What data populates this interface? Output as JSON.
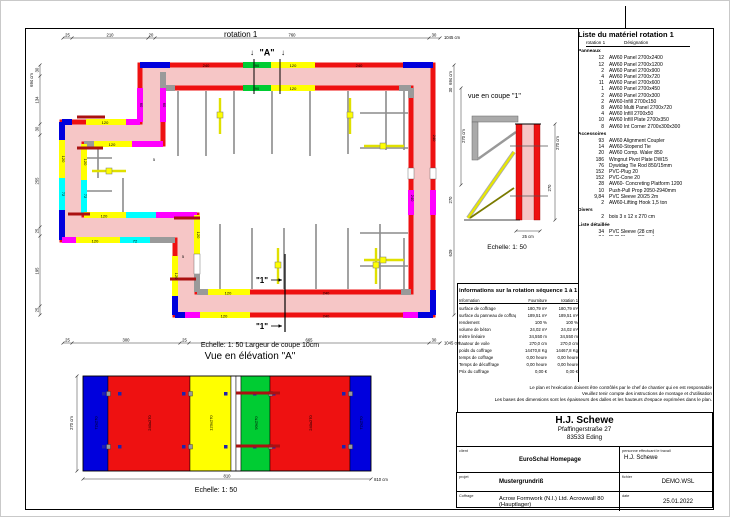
{
  "page": {
    "plan_heading": "rotation 1",
    "scale_note": "Echelle: 1: 50   Largeur de coupe 10cm",
    "elevation_title": "Vue en élévation \"A\"",
    "elevation_scale": "Echelle: 1: 50",
    "section_title": "vue en coupe \"1\"",
    "section_scale": "Echelle: 1: 50",
    "marker_a": "\"A\"",
    "marker_1": "\"1\"",
    "arrow_down": "↓"
  },
  "plan": {
    "labels": {
      "p240": "240",
      "p120": "120",
      "p90": "90",
      "p60": "60",
      "p72": "72",
      "p5": "5"
    },
    "dims_top": {
      "d1": "25",
      "d2": "210",
      "d3": "20",
      "d4": "760",
      "d5": "30",
      "total": "1045 cm"
    },
    "dims_bottom": {
      "d1": "25",
      "d2": "300",
      "d3": "25",
      "d4": "665",
      "d5": "30",
      "total": "1045 cm"
    },
    "dims_left": {
      "total": "694 cm",
      "d1": "30",
      "d2": "134",
      "d3": "30",
      "d4": "255",
      "d5": "25",
      "d6": "195",
      "d7": "25"
    },
    "dims_right": {
      "total": "694 cm",
      "d1": "30",
      "d2": "270 cm",
      "d3": "270",
      "d4": "629"
    }
  },
  "section": {
    "dim_height": "270 cm",
    "dim_wall": "270",
    "dim_width": "25 cm"
  },
  "elevation": {
    "dim_total_short": "810",
    "dim_total": "810 cm",
    "dim_height": "270 cm",
    "panels": [
      {
        "label": "72x270",
        "color": "#0000dd",
        "x": 25,
        "w": 25
      },
      {
        "label": "240x270",
        "color": "#ee1111",
        "x": 50,
        "w": 82
      },
      {
        "label": "120x270",
        "color": "#ffff00",
        "x": 132,
        "w": 41
      },
      {
        "label": "",
        "color": "#ffffff",
        "x": 173,
        "w": 5
      },
      {
        "label": "",
        "color": "#ffffff",
        "x": 178,
        "w": 5
      },
      {
        "label": "90x270",
        "color": "#00cc33",
        "x": 183,
        "w": 29
      },
      {
        "label": "240x270",
        "color": "#ee1111",
        "x": 212,
        "w": 80
      },
      {
        "label": "72x270",
        "color": "#0000dd",
        "x": 292,
        "w": 21
      }
    ]
  },
  "material_list": {
    "title": "Liste du matériel  rotation 1",
    "col_qty": "rotation 1",
    "col_name": "Désignation",
    "sections": [
      {
        "name": "Panneaux",
        "items": [
          [
            "12",
            "AW60 Panel 2700x2400"
          ],
          [
            "12",
            "AW60 Panel 2700x1200"
          ],
          [
            "2",
            "AW60 Panel 2700x900"
          ],
          [
            "4",
            "AW60 Panel 2700x720"
          ],
          [
            "11",
            "AW60 Panel 2700x600"
          ],
          [
            "1",
            "AW60 Panel 2700x450"
          ],
          [
            "2",
            "AW60 Panel 2700x300"
          ],
          [
            "2",
            "AW60-Infill 2700x150"
          ],
          [
            "8",
            "AW60 Multi Panel 2700x720"
          ],
          [
            "4",
            "AW60 Infill 2700x50"
          ],
          [
            "10",
            "AW60 Infill Plate 2700x350"
          ],
          [
            "8",
            "AW60 Int Corner 2700x300x300"
          ]
        ]
      },
      {
        "name": "Accessoires",
        "items": [
          [
            "93",
            "AW60 Alignment Coupler"
          ],
          [
            "14",
            "AW60-Stopend Tie"
          ],
          [
            "20",
            "AW60 Comp. Waler 850"
          ],
          [
            "186",
            "Wingnut Pivot Plate DW15"
          ],
          [
            "76",
            "Dywidag Tie Rod  850/15mm"
          ],
          [
            "152",
            "PVC-Plug 20"
          ],
          [
            "152",
            "PVC-Cone 20"
          ],
          [
            "28",
            "AW60- Concreting Platform 1200"
          ],
          [
            "10",
            "Push-Pull Prop 2050-2940mm"
          ],
          [
            "9,84",
            "PVC Sleeve 20/25  2m"
          ],
          [
            "2",
            "AW60-Lifting Hook 1,5 ton"
          ]
        ]
      },
      {
        "name": "Divers",
        "items": [
          [
            "2",
            "bois 3 x 12 x 270 cm"
          ]
        ]
      },
      {
        "name": "Liste détaillée",
        "items": [
          [
            "34",
            "PVC Sleeve  (28 cm)"
          ],
          [
            "34",
            "PVC Sleeve  (23 cm)"
          ],
          [
            "8",
            "PVC Sleeve  (18 cm)"
          ]
        ]
      }
    ]
  },
  "info_table": {
    "title": "informations sur la rotation  séquence 1 à 1",
    "col_info": "Information",
    "col_supply": "Fourniture",
    "col_rot": "rotation 1",
    "rows": [
      [
        "surface de coffrage",
        "180,79 m²",
        "180,79 m²"
      ],
      [
        "surface du panneau de coffrage",
        "189,51 m²",
        "189,51 m²"
      ],
      [
        "rendement",
        "100 %",
        "100 %"
      ],
      [
        "volume de béton",
        "24,02 m³",
        "24,02 m³"
      ],
      [
        "mètre linéaire",
        "34,550 m",
        "34,550 m"
      ],
      [
        "hauteur de voile",
        "270,0 cm",
        "270,0 cm"
      ],
      [
        "poids du coffrage",
        "14470,8 Kg",
        "14467,8 Kg"
      ],
      [
        "temps de coffrage",
        "0,00 heure",
        "0,00 heure"
      ],
      [
        "Temps de décoffrage",
        "0,00 heure",
        "0,00 heure"
      ],
      [
        "Prix du coffrage",
        "0,00 €",
        "0,00 €"
      ]
    ]
  },
  "disclaimer": {
    "line1": "Le plan et l'exécution doivent être contrôlés par le chef de chantier qui en est responsable",
    "line2": "Veuillez tenir compte des instructions de montage et d'utilisation",
    "line3": "Les bases des dimensions sont les épaisseurs des dalles et les hauteurs d'espace exprimées dans le plan."
  },
  "title_block": {
    "company": "H.J. Schewe",
    "address1": "Pfaffingerstraße 27",
    "address2": "83533 Eding",
    "client_label": "client",
    "client": "EuroSchal Homepage",
    "worker_label": "personne effectuant le travail",
    "worker": "H.J. Schewe",
    "project_label": "projet",
    "project": "Mustergrundriß",
    "file_label": "fichier",
    "file": "DEMO.WSL",
    "formwork_label": "Coffrage",
    "formwork": "Acrow Formwork (N.I.) Ltd. Acrowwall 80 (Hauptlager)",
    "date_label": "date",
    "date": "25.01.2022"
  },
  "colors": {
    "red": "#ee1111",
    "wall_pink": "#f6c6c6",
    "yellow": "#ffff00",
    "green": "#00cc33",
    "blue": "#0000dd",
    "magenta": "#ff00ff",
    "cyan": "#00ffff",
    "gray": "#9a9a9a",
    "dark_red": "#aa1111",
    "olive": "#7a7a00"
  }
}
